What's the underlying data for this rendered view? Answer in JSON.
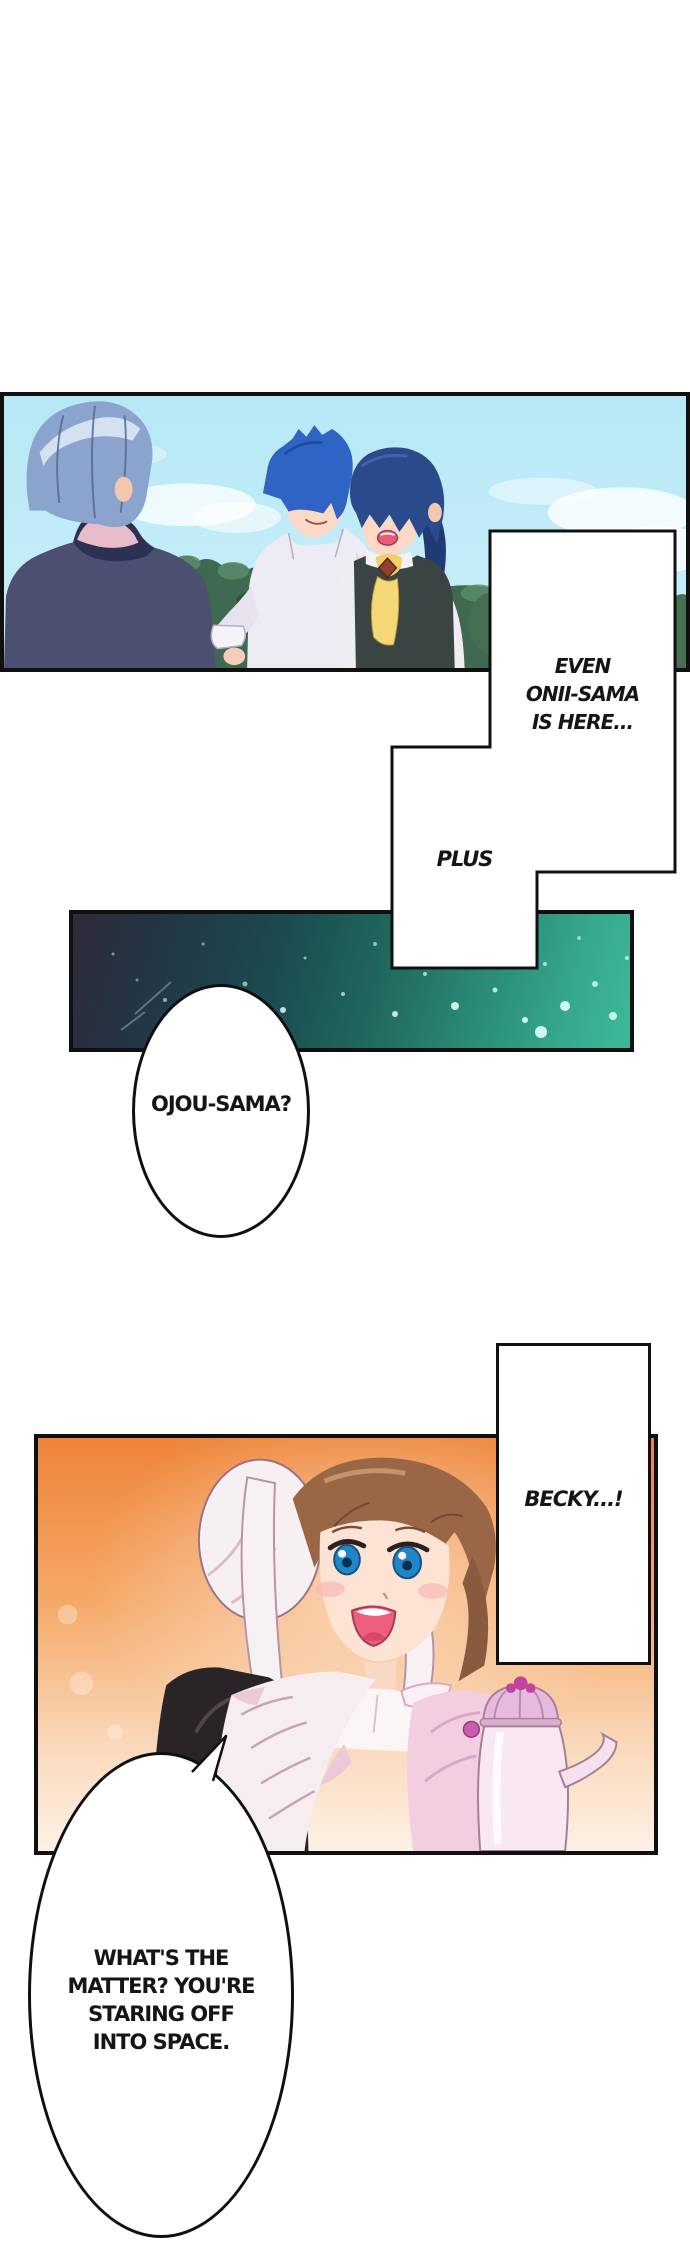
{
  "page": {
    "width": 690,
    "height": 2255,
    "background": "#ffffff",
    "panel_border_color": "#101010",
    "text_color": "#151515"
  },
  "bubbles": {
    "even": {
      "lines": [
        "EVEN",
        "ONII-SAMA",
        "IS HERE..."
      ]
    },
    "plus": {
      "label": "PLUS"
    },
    "ojou": {
      "label": "OJOU-SAMA?"
    },
    "becky": {
      "label": "BECKY...!"
    },
    "matter": {
      "lines": [
        "WHAT'S THE",
        "MATTER? YOU'RE",
        "STARING OFF",
        "INTO SPACE."
      ]
    }
  },
  "panels": {
    "outdoor": {
      "sky_top": "#b7e8f6",
      "sky_bottom": "#cfeff9",
      "tree_green": "#3f6950",
      "hair_gray_blue": "#8ba4ce",
      "hair_blue": "#2f63c4",
      "hair_navy": "#2b4a8c",
      "scarf_yellow": "#f2cf6a",
      "jacket_slate": "#4b4f70",
      "shirt_white": "#edebf3"
    },
    "galaxy": {
      "left_color": "#2e2a38",
      "mid_color": "#1b4a50",
      "right_color": "#3db89b",
      "sparkle_color": "#d8fff4"
    },
    "maid": {
      "orange_top": "#ee8438",
      "orange_bottom": "#fdf1e6",
      "cap_white": "#f7f0f3",
      "hair_brown": "#9a6746",
      "eye_blue": "#1f86c8",
      "mouth_pink": "#ef5d7d",
      "dress_black": "#2a2428",
      "apron_white": "#f5edf0",
      "sleeve_pink": "#f3cde0",
      "teapot_body": "#f8e8f2",
      "teapot_lid": "#e6bade",
      "teapot_finial": "#c2439e"
    }
  }
}
